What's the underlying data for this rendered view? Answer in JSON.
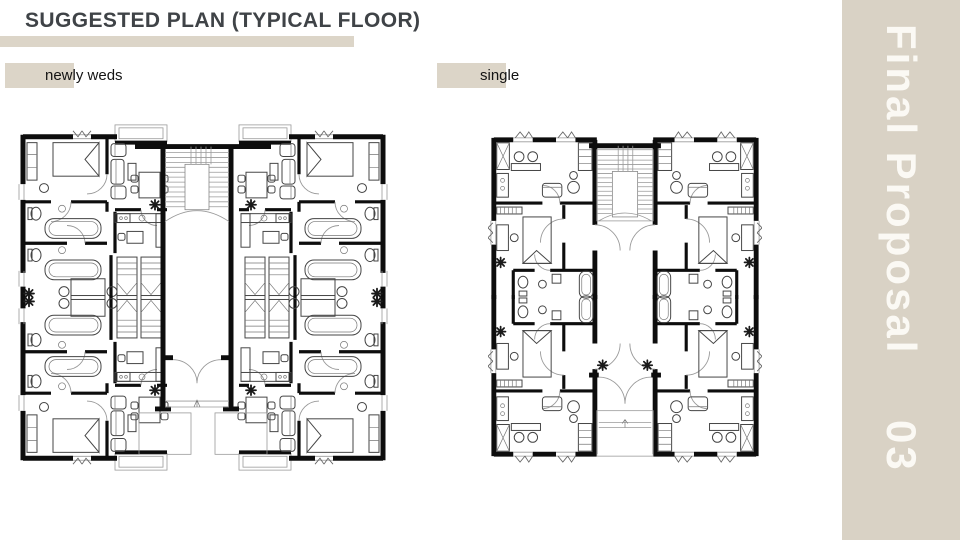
{
  "header": {
    "title": "SUGGESTED PLAN (TYPICAL FLOOR)"
  },
  "plans": [
    {
      "id": "newlyweds",
      "label": "newly weds"
    },
    {
      "id": "single",
      "label": "single"
    }
  ],
  "sidebar": {
    "title": "Final Proposal",
    "number": "03"
  },
  "footer": {
    "page_number": "16"
  },
  "colors": {
    "accent_beige": "#DCD5C8",
    "sidebar_beige": "#D9D2C5",
    "title_text": "#3F4347",
    "label_text": "#141414",
    "sidebar_text": "#FBF9F4",
    "page_number_text": "#8A8A8A",
    "plan_ink": "#0D0D0D"
  }
}
